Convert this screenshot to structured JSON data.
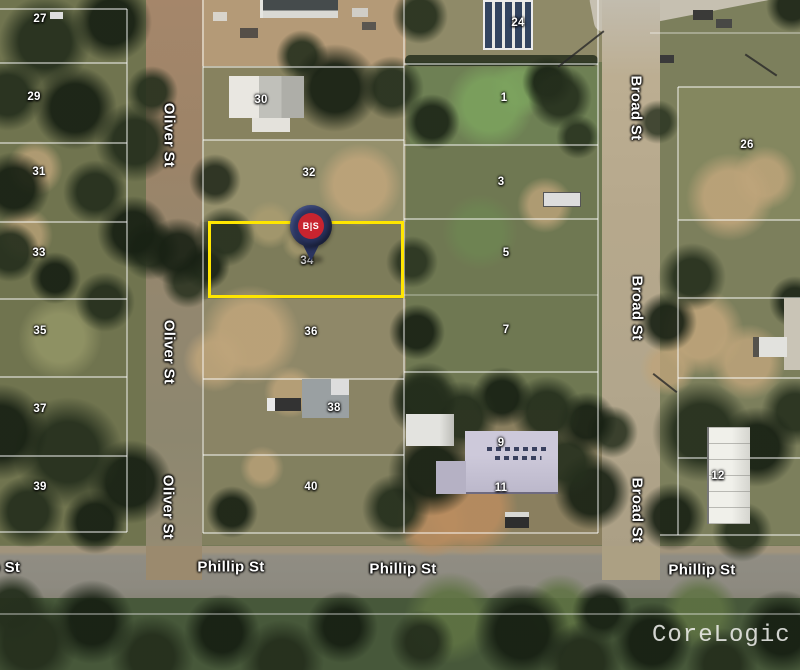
{
  "map": {
    "watermark": "CoreLogic",
    "marker": {
      "label": "B|S"
    },
    "highlighted_lot": "34",
    "streets": {
      "oliver": "Oliver St",
      "broad": "Broad St",
      "phillip": "Phillip St"
    },
    "lot_numbers": [
      "27",
      "29",
      "31",
      "33",
      "35",
      "37",
      "39",
      "30",
      "32",
      "34",
      "36",
      "38",
      "40",
      "24",
      "1",
      "3",
      "5",
      "7",
      "9",
      "11",
      "26",
      "12"
    ]
  },
  "colors": {
    "highlight": "#ffe600",
    "pin": "#2a3460",
    "badge": "#c8242f"
  }
}
